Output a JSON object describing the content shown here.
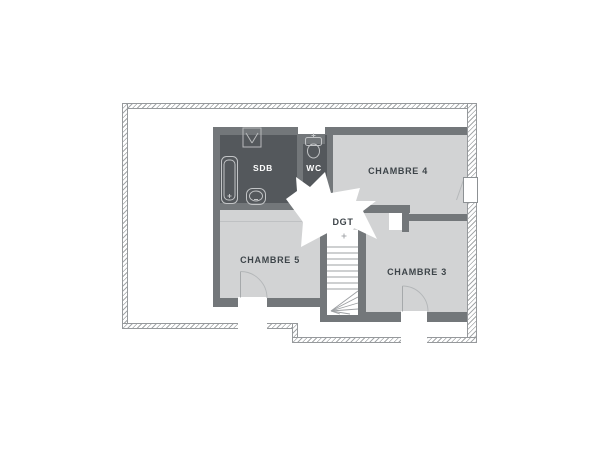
{
  "plan": {
    "rooms": {
      "sdb": {
        "label": "SDB"
      },
      "wc": {
        "label": "WC"
      },
      "chambre4": {
        "label": "CHAMBRE 4"
      },
      "chambre5": {
        "label": "CHAMBRE 5"
      },
      "chambre3": {
        "label": "CHAMBRE 3"
      },
      "dgt": {
        "label": "DGT"
      }
    },
    "colors": {
      "background": "#ffffff",
      "interior_wall": "#73777a",
      "dark_room_fill": "#54585c",
      "light_room_fill": "#d2d3d4",
      "hallway_fill": "#ffffff",
      "hatch_line": "#a5a8aa",
      "label_dark": "#3d4449",
      "label_light": "#ffffff",
      "fixture_stroke": "#c2c4c6"
    }
  }
}
